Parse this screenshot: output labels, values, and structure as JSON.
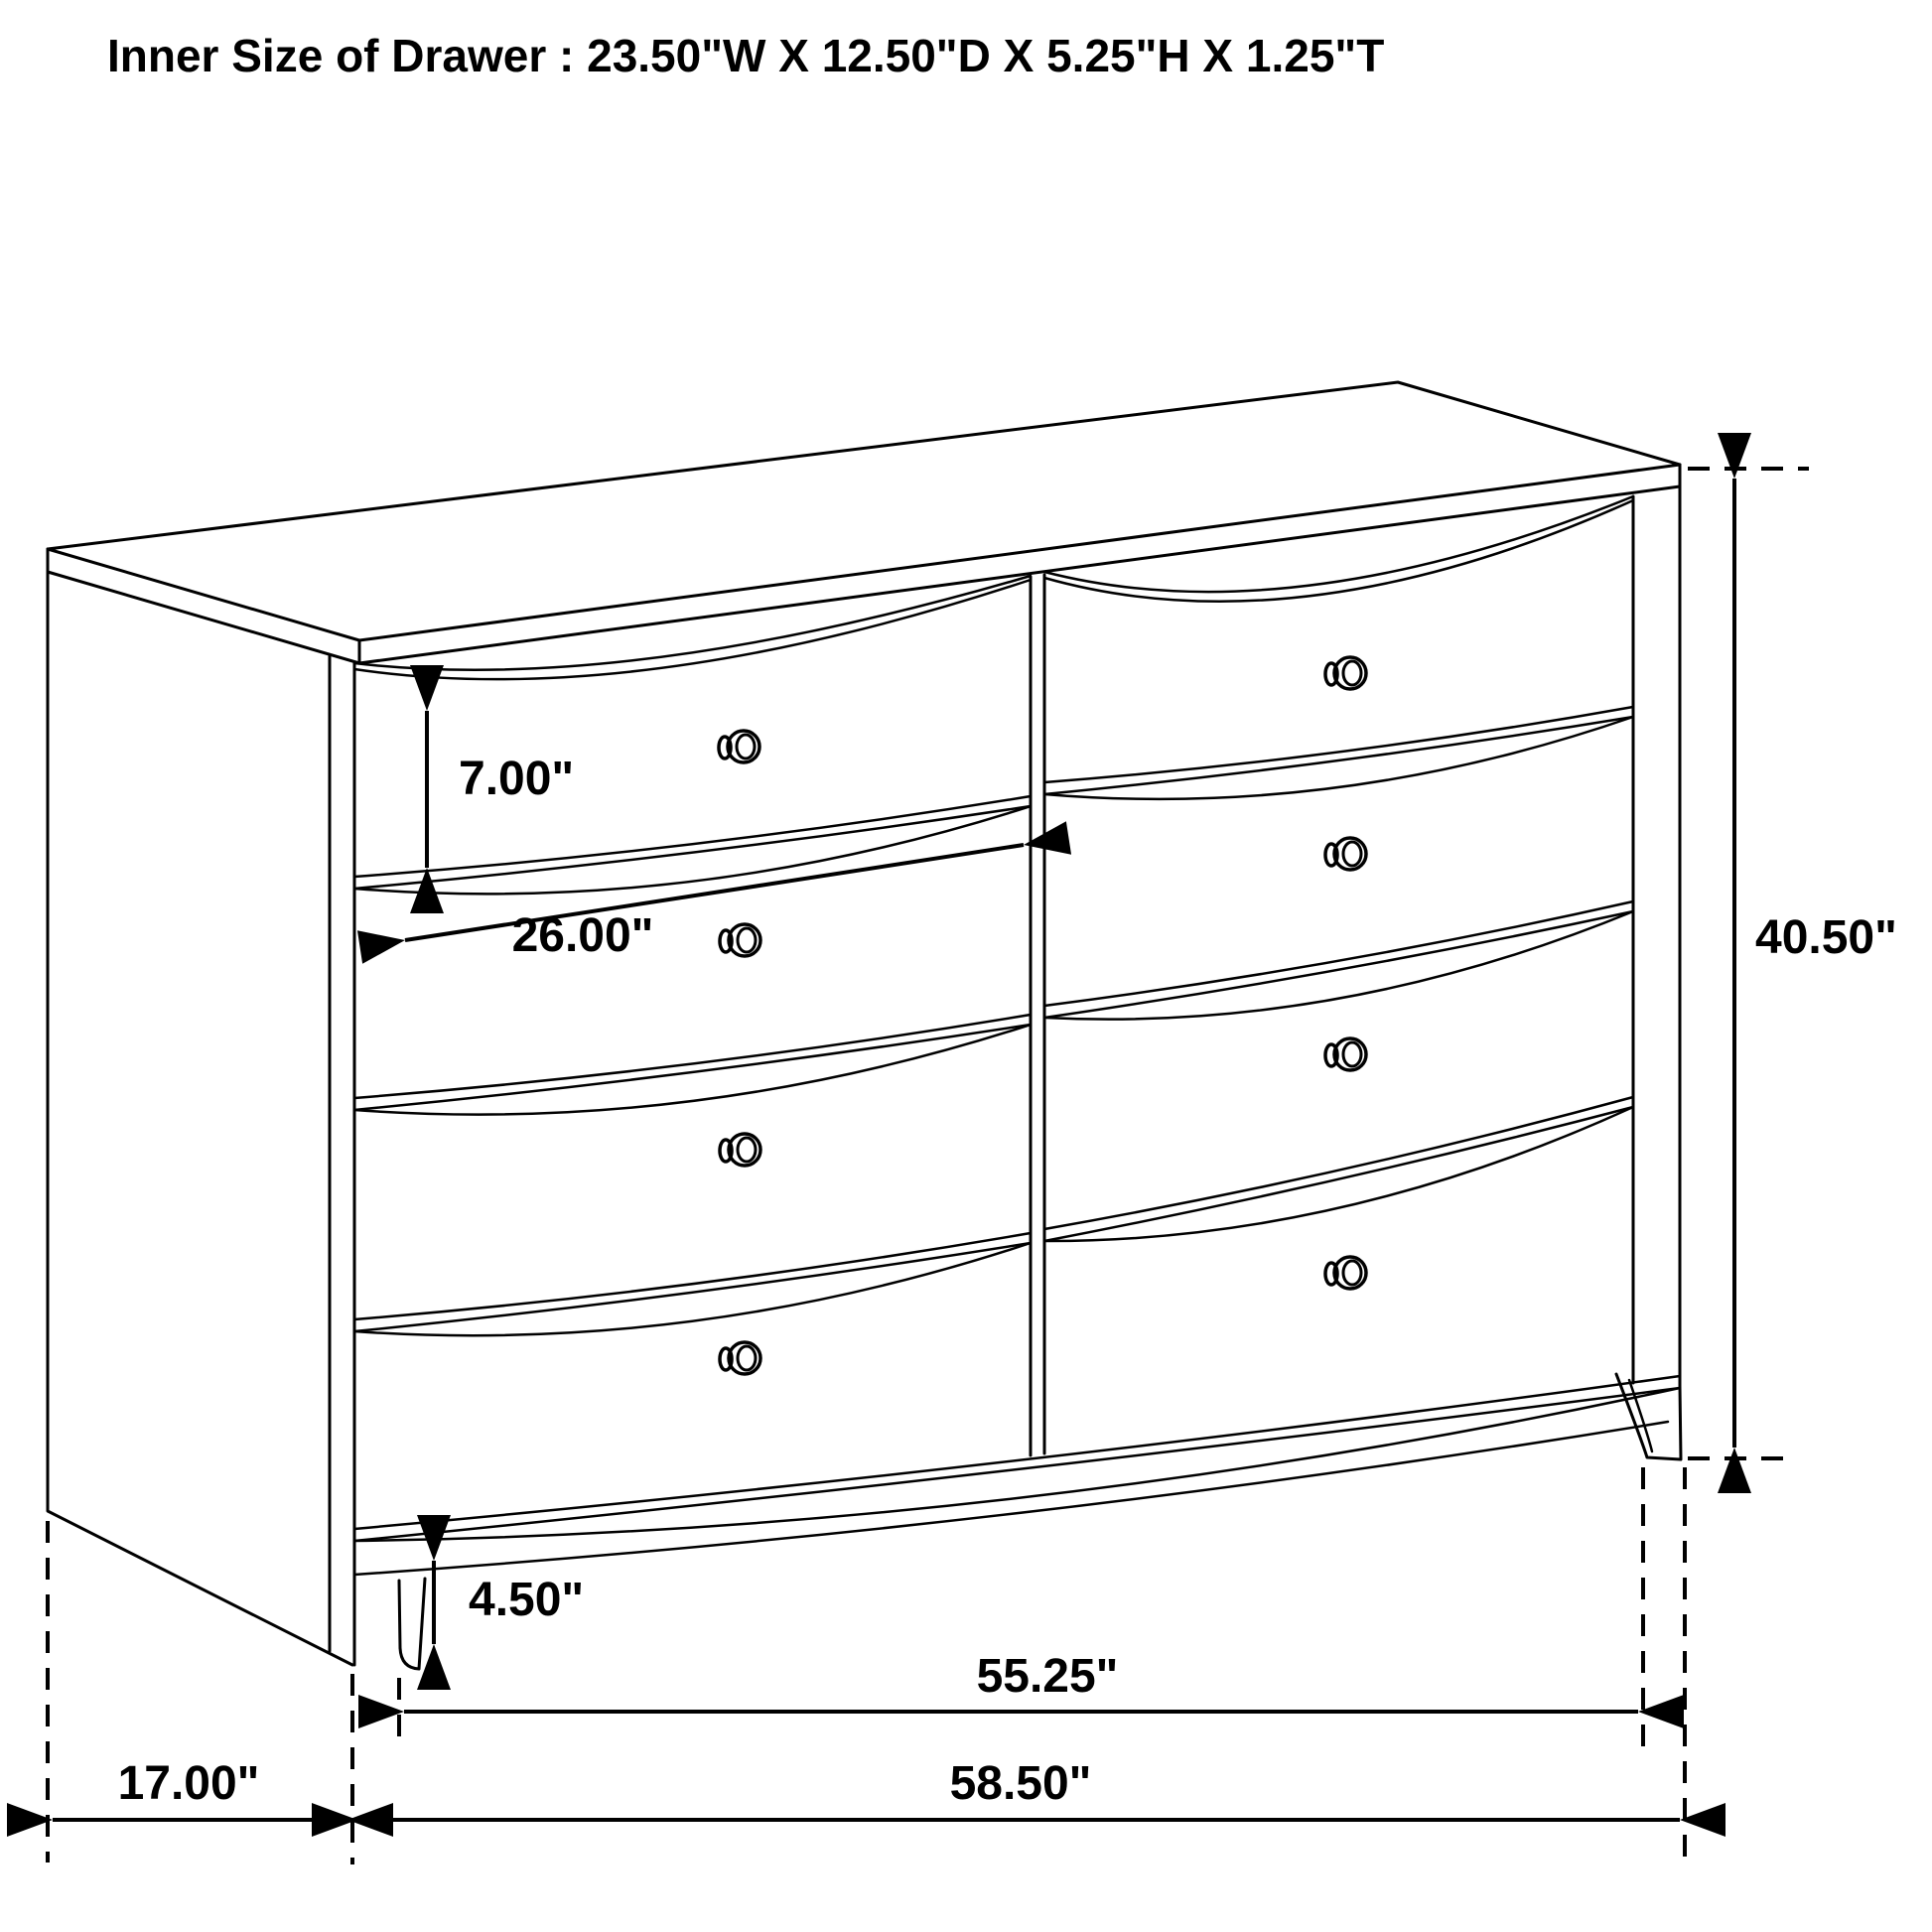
{
  "title": "Inner Size of Drawer : 23.50\"W X 12.50\"D X 5.25\"H X 1.25\"T",
  "colors": {
    "line": "#000000",
    "background": "#ffffff",
    "text": "#000000"
  },
  "drawing": {
    "type": "technical-dimension-drawing",
    "subject": "eight-drawer dresser, front-left perspective line art",
    "drawer_knob_count": 8
  },
  "dimensions": {
    "drawer_front_height": "7.00\"",
    "drawer_opening_width": "26.00\"",
    "overall_height": "40.50\"",
    "leg_height": "4.50\"",
    "width_between_legs": "55.25\"",
    "side_depth": "17.00\"",
    "overall_width": "58.50\""
  }
}
